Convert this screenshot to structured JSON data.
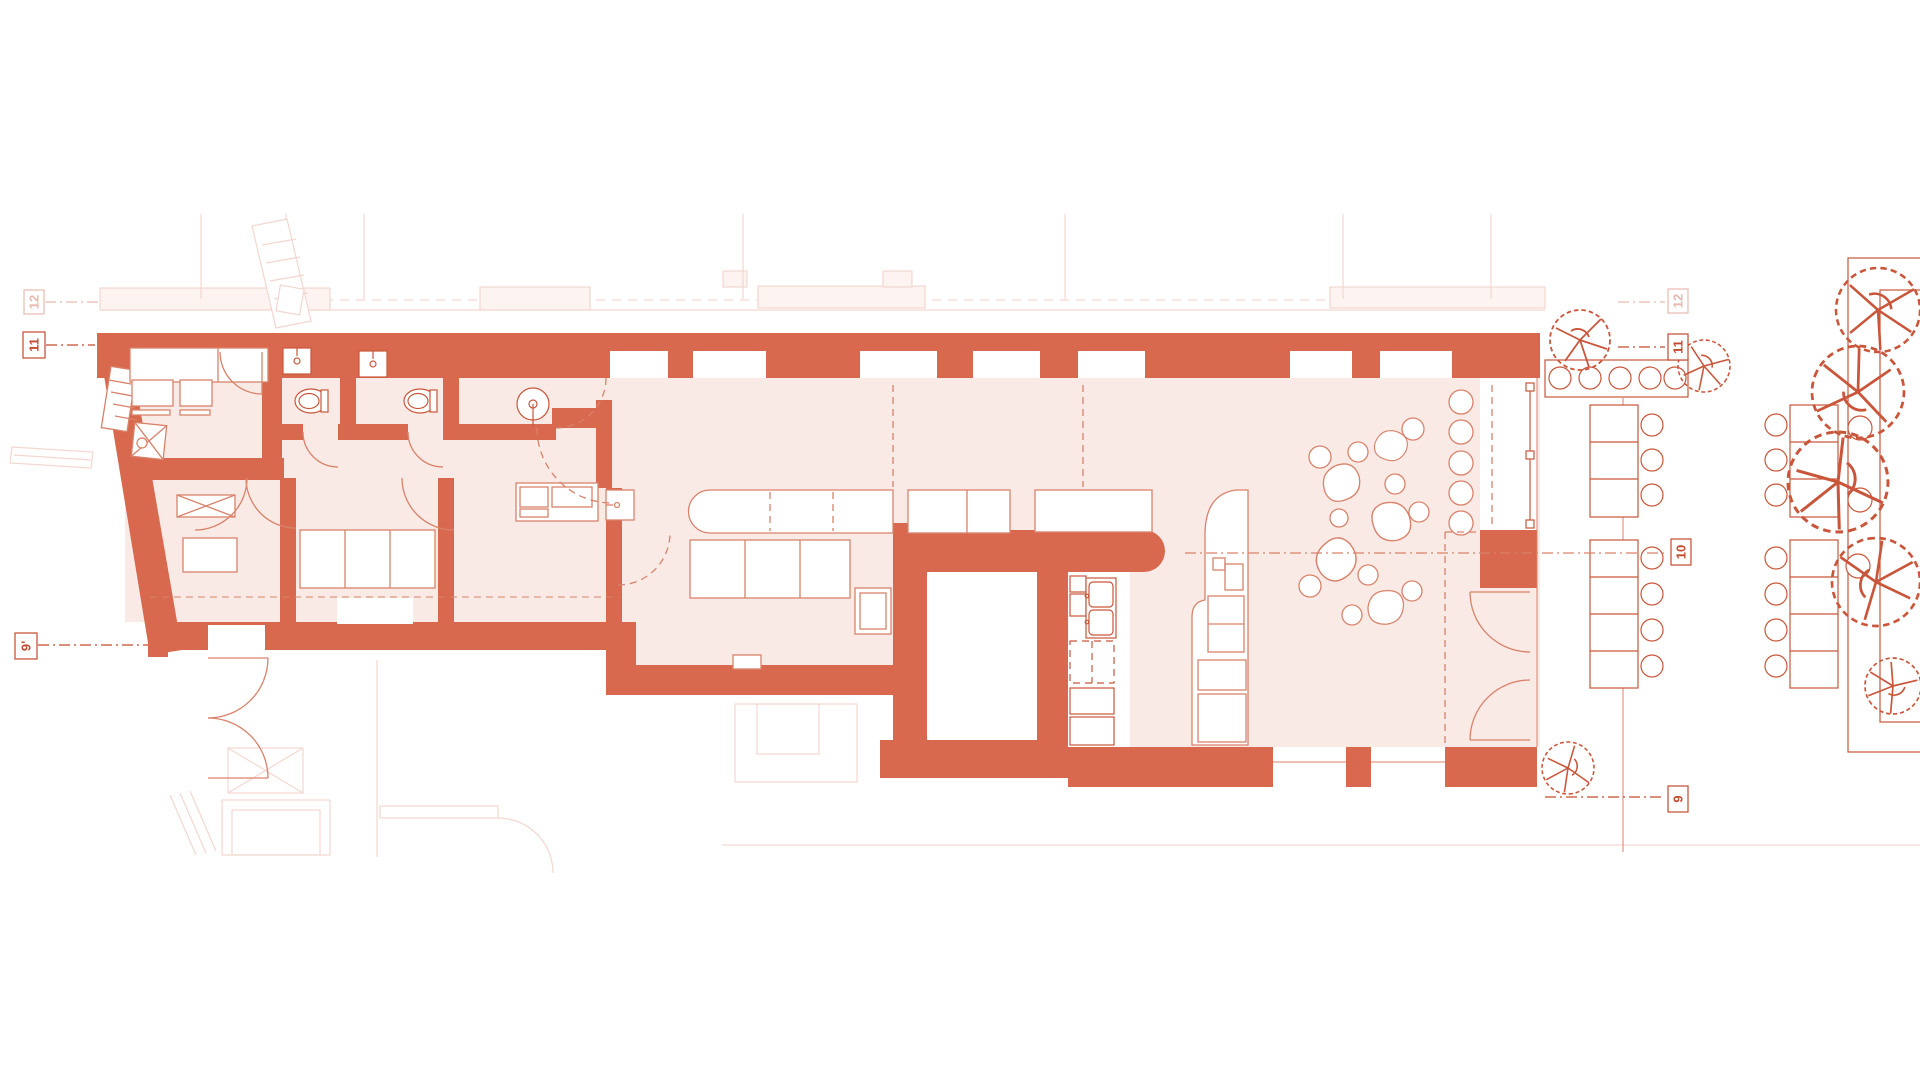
{
  "document": {
    "type": "architectural floor plan",
    "view": "top-down plan of a long bar/restaurant unit with street terrace",
    "sheet_background": "white"
  },
  "colors": {
    "wall": "#d8694e",
    "room": "#faeae6",
    "line": "#d9826a",
    "line_strong": "#c9563a",
    "faint": "#f2d7cf",
    "faint_fill": "#fdf4f1",
    "marker": "#c44a2e",
    "white": "#ffffff"
  },
  "grid_markers": {
    "left": [
      {
        "label": "12",
        "style": "faint"
      },
      {
        "label": "11",
        "style": "normal"
      },
      {
        "label": "9'",
        "style": "normal"
      }
    ],
    "right": [
      {
        "label": "12",
        "style": "faint"
      },
      {
        "label": "11",
        "style": "normal"
      },
      {
        "label": "10",
        "style": "normal"
      },
      {
        "label": "9",
        "style": "normal"
      }
    ]
  },
  "inventory": {
    "left_wing_rooms": [
      "office",
      "wc-1",
      "wc-2",
      "washroom",
      "shower-room",
      "storage-rooms",
      "corridor"
    ],
    "main_space": [
      "bar-counter",
      "open-dining-area",
      "kitchen-line",
      "service-island",
      "pebble-floor-decor",
      "courtyard-notch",
      "glazed-entrance"
    ],
    "terrace": [
      "bench-row",
      "table-groups-with-chairs",
      "street-trees",
      "planter-strip"
    ],
    "counts": {
      "trees": 8,
      "terrace_table_groups": 4,
      "window-stools": 5,
      "toilets": 2,
      "sinks": 5,
      "pebbles": 15
    }
  }
}
